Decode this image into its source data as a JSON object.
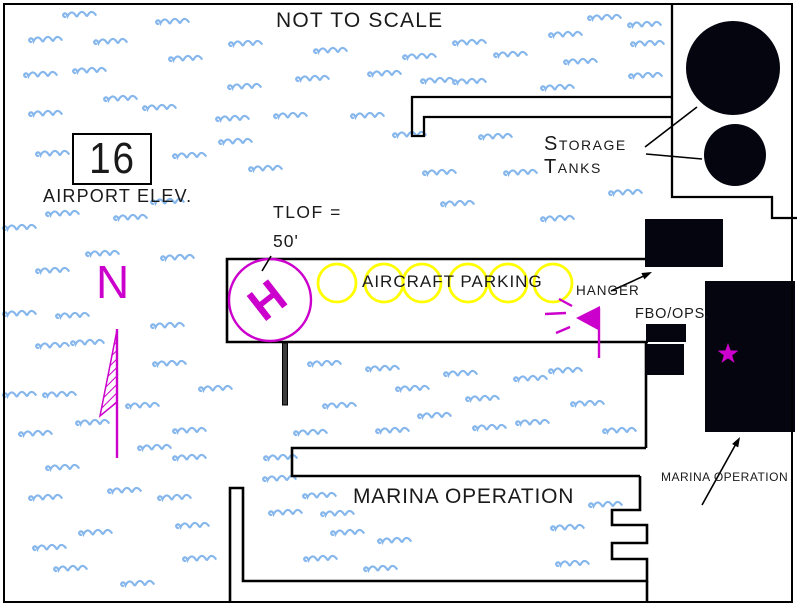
{
  "title": "NOT TO SCALE",
  "airport": {
    "elevation_value": "16",
    "elevation_label": "AIRPORT ELEV."
  },
  "helipad": {
    "tlof_label_line1": "TLOF =",
    "tlof_label_line2": "50'",
    "h_marking": "H"
  },
  "parking": {
    "label": "AIRCRAFT PARKING",
    "spot_count": 6,
    "spots_x": [
      337,
      384,
      422,
      468,
      508,
      553
    ],
    "spots_y": 283,
    "spot_radius": 19
  },
  "buildings": {
    "hanger_label": "HANGER",
    "fbo_label": "FBO/OPS.",
    "marina_building_label": "MARINA OPERATION"
  },
  "storage_tanks": {
    "count": 2,
    "label_line1": "Storage",
    "label_line2": "Tanks"
  },
  "marina": {
    "big_label": "MARINA OPERATION"
  },
  "compass": {
    "north_label": "N"
  },
  "colors": {
    "water_wave": "#85B6EC",
    "magenta_accent": "#CC00CC",
    "parking_yellow": "#FFFF00",
    "line_black": "#000000"
  },
  "waves": [
    [
      62,
      8
    ],
    [
      155,
      15
    ],
    [
      587,
      11
    ],
    [
      627,
      18
    ],
    [
      28,
      33
    ],
    [
      93,
      35
    ],
    [
      228,
      37
    ],
    [
      313,
      44
    ],
    [
      452,
      36
    ],
    [
      548,
      28
    ],
    [
      630,
      37
    ],
    [
      168,
      52
    ],
    [
      402,
      50
    ],
    [
      493,
      48
    ],
    [
      563,
      55
    ],
    [
      23,
      68
    ],
    [
      72,
      64
    ],
    [
      367,
      67
    ],
    [
      420,
      74
    ],
    [
      452,
      75
    ],
    [
      295,
      72
    ],
    [
      628,
      69
    ],
    [
      540,
      81
    ],
    [
      227,
      80
    ],
    [
      103,
      92
    ],
    [
      142,
      101
    ],
    [
      28,
      107
    ],
    [
      273,
      109
    ],
    [
      350,
      109
    ],
    [
      215,
      112
    ],
    [
      35,
      147
    ],
    [
      172,
      149
    ],
    [
      218,
      135
    ],
    [
      248,
      162
    ],
    [
      392,
      128
    ],
    [
      478,
      130
    ],
    [
      422,
      166
    ],
    [
      503,
      166
    ],
    [
      440,
      197
    ],
    [
      608,
      186
    ],
    [
      150,
      195
    ],
    [
      45,
      207
    ],
    [
      2,
      221
    ],
    [
      113,
      211
    ],
    [
      85,
      247
    ],
    [
      160,
      251
    ],
    [
      35,
      264
    ],
    [
      540,
      212
    ],
    [
      2,
      307
    ],
    [
      55,
      309
    ],
    [
      150,
      319
    ],
    [
      35,
      339
    ],
    [
      70,
      336
    ],
    [
      152,
      357
    ],
    [
      307,
      357
    ],
    [
      365,
      362
    ],
    [
      443,
      367
    ],
    [
      513,
      372
    ],
    [
      548,
      364
    ],
    [
      2,
      388
    ],
    [
      42,
      388
    ],
    [
      198,
      382
    ],
    [
      125,
      399
    ],
    [
      395,
      382
    ],
    [
      465,
      392
    ],
    [
      570,
      397
    ],
    [
      75,
      416
    ],
    [
      172,
      424
    ],
    [
      322,
      399
    ],
    [
      417,
      409
    ],
    [
      472,
      421
    ],
    [
      515,
      416
    ],
    [
      602,
      424
    ],
    [
      18,
      427
    ],
    [
      293,
      426
    ],
    [
      375,
      424
    ],
    [
      137,
      441
    ],
    [
      172,
      451
    ],
    [
      45,
      461
    ],
    [
      263,
      451
    ],
    [
      107,
      484
    ],
    [
      157,
      491
    ],
    [
      28,
      491
    ],
    [
      262,
      472
    ],
    [
      302,
      489
    ],
    [
      588,
      498
    ],
    [
      175,
      519
    ],
    [
      78,
      526
    ],
    [
      268,
      506
    ],
    [
      320,
      507
    ],
    [
      550,
      521
    ],
    [
      32,
      541
    ],
    [
      182,
      552
    ],
    [
      330,
      526
    ],
    [
      377,
      534
    ],
    [
      53,
      562
    ],
    [
      120,
      577
    ],
    [
      303,
      552
    ],
    [
      363,
      562
    ],
    [
      555,
      557
    ]
  ]
}
